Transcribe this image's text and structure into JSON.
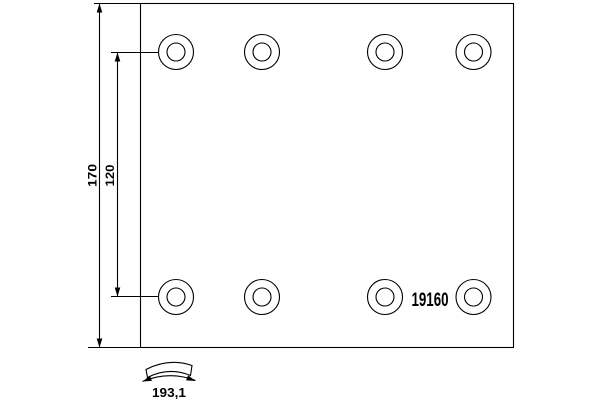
{
  "part_number": "19160",
  "dimensions": {
    "plate_height": "170",
    "hole_row_spacing": "120",
    "arc_width": "193,1"
  },
  "holes": {
    "count": 8,
    "rows": 2,
    "columns": 4,
    "centers_x": [
      176,
      262,
      385,
      473.5
    ],
    "centers_y": [
      52,
      297
    ],
    "outer_radius": 17.5,
    "inner_radius": 9
  },
  "colors": {
    "line": "#000000",
    "background": "#ffffff"
  }
}
